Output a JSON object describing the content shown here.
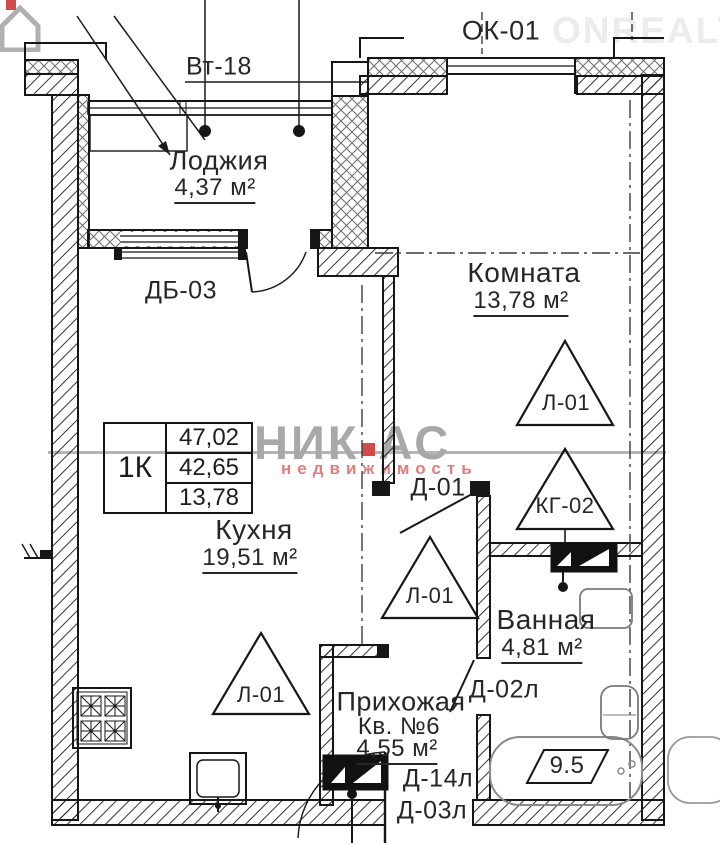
{
  "watermark": {
    "brand_left": "НИК",
    "brand_right": "АС",
    "brand_sub": "недвижимость",
    "corner": "ONREALT",
    "brand_color": "#a8a8a8",
    "accent_color": "#d4494a"
  },
  "plan": {
    "labels": {
      "vt18": "Вт-18",
      "ok01": "ОК-01",
      "db03": "ДБ-03",
      "d01": "Д-01",
      "d02l": "Д-02л",
      "d14l": "Д-14л",
      "d03l": "Д-03л",
      "kg02": "КГ-02",
      "l01": "Л-01",
      "tub_value": "9.5"
    },
    "rooms": {
      "loggia": {
        "name": "Лоджия",
        "area": "4,37 м²"
      },
      "room": {
        "name": "Комната",
        "area": "13,78 м²"
      },
      "kitchen": {
        "name": "Кухня",
        "area": "19,51 м²"
      },
      "bathroom": {
        "name": "Ванная",
        "area": "4,81 м²"
      },
      "hall": {
        "name": "Прихожая",
        "unit": "Кв. №6",
        "area": "4,55 м²"
      }
    },
    "info_table": {
      "type": "1К",
      "values": [
        "47,02",
        "42,65",
        "13,78"
      ]
    }
  }
}
